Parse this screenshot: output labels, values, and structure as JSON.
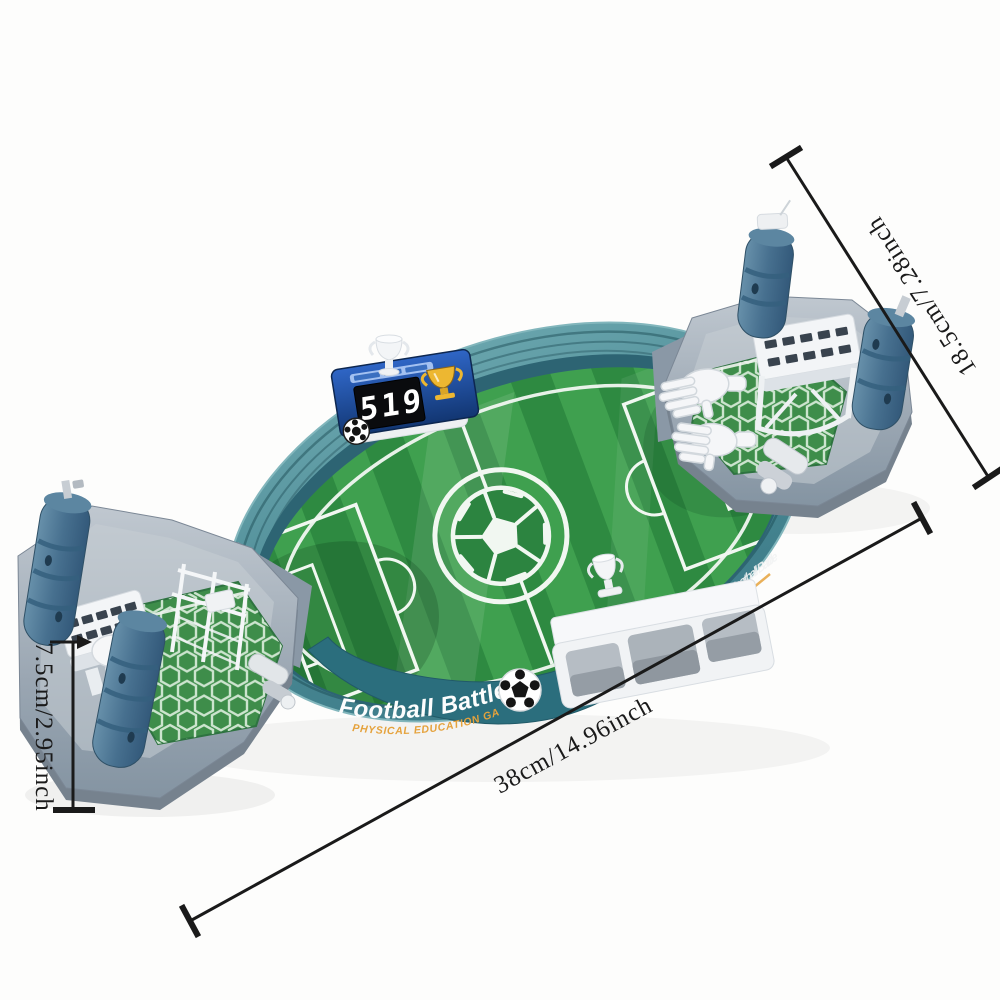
{
  "page": {
    "background": "#fdfdfc",
    "description": "Product photo of a tabletop football battle board game shown at an angle with black size dimension lines"
  },
  "product": {
    "banner": {
      "title": "Football Battle",
      "subtitle": "PHYSICAL EDUCATION GAME"
    },
    "scoreboard": {
      "display": "519"
    },
    "colors": {
      "stadium_wall": "#4a8893",
      "banner": "#2b6e7d",
      "field_dark": "#2e8a41",
      "field_light": "#3fa04f",
      "platform_gray": "#a4aeb9",
      "grip_blue": "#47708f",
      "scoreboard_blue": "#1d4da8",
      "trophy_gold": "#edb731",
      "white_parts": "#f3f5f7"
    }
  },
  "annotations": {
    "color": "#1a1a1a",
    "side": {
      "label": "18.5cm/7.28inch"
    },
    "length": {
      "label": "38cm/14.96inch"
    },
    "height": {
      "label": "7.5cm/2.95inch"
    }
  }
}
